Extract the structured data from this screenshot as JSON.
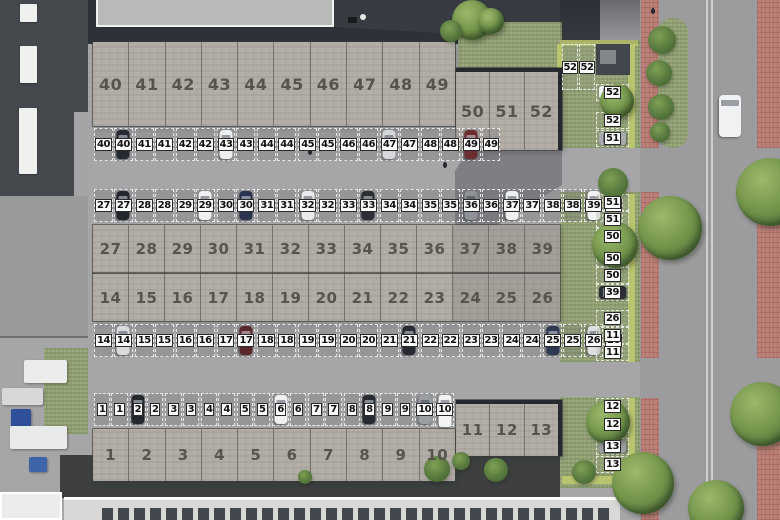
{
  "palette": {
    "asphalt": "#a6a6a8",
    "dark_roof": "#383c42",
    "brick_building": "#b2aea6",
    "grass": "#93a274",
    "hedge": "#b9c46f",
    "red_bike_path": "#bb8078",
    "road": "#9c9c9e",
    "road_line": "#cfcfd1",
    "white_roof": "#d8d8d6",
    "solar_panel": "#42464d",
    "unit_text": "#57544e",
    "chip_bg": "#fafafa",
    "chip_text": "#111111"
  },
  "buildings": [
    {
      "name": "building-units-40-49",
      "x": 93,
      "y": 42,
      "w": 362,
      "h": 84,
      "label_size": 16,
      "units": [
        "40",
        "41",
        "42",
        "43",
        "44",
        "45",
        "46",
        "47",
        "48",
        "49"
      ]
    },
    {
      "name": "building-units-50-52",
      "x": 456,
      "y": 68,
      "w": 106,
      "h": 82,
      "label_size": 16,
      "roof_edge": true,
      "units": [
        "50",
        "51",
        "52"
      ]
    },
    {
      "name": "building-units-27-39",
      "x": 93,
      "y": 225,
      "w": 467,
      "h": 48,
      "label_size": 15,
      "dark_from": 10,
      "units": [
        "27",
        "28",
        "29",
        "30",
        "31",
        "32",
        "33",
        "34",
        "35",
        "36",
        "37",
        "38",
        "39"
      ]
    },
    {
      "name": "building-units-14-26",
      "x": 93,
      "y": 273,
      "w": 467,
      "h": 48,
      "label_size": 15,
      "dark_from": 10,
      "divider": true,
      "units": [
        "14",
        "15",
        "16",
        "17",
        "18",
        "19",
        "20",
        "21",
        "22",
        "23",
        "24",
        "25",
        "26"
      ]
    },
    {
      "name": "building-units-1-10",
      "x": 93,
      "y": 429,
      "w": 362,
      "h": 52,
      "label_size": 15,
      "units": [
        "1",
        "2",
        "3",
        "4",
        "5",
        "6",
        "7",
        "8",
        "9",
        "10"
      ]
    },
    {
      "name": "building-units-11-13",
      "x": 456,
      "y": 400,
      "w": 106,
      "h": 56,
      "label_size": 15,
      "roof_edge": true,
      "units": [
        "11",
        "12",
        "13"
      ]
    }
  ],
  "parking_rows": [
    {
      "name": "parking-row-40-49",
      "x": 93,
      "y": 126,
      "w": 362,
      "h": 37,
      "labels": [
        "40",
        "41",
        "42",
        "43",
        "44",
        "45",
        "46",
        "47",
        "48",
        "49"
      ],
      "cars": [
        {
          "g": 0,
          "s": 1,
          "c": "#262a33"
        },
        {
          "g": 3,
          "s": 0,
          "c": "#edeff1"
        },
        {
          "g": 7,
          "s": 0,
          "c": "#d5d7da"
        },
        {
          "g": 9,
          "s": 0,
          "c": "#6d2b32"
        }
      ]
    },
    {
      "name": "parking-row-27-39",
      "x": 93,
      "y": 187,
      "w": 467,
      "h": 37,
      "labels": [
        "27",
        "28",
        "29",
        "30",
        "31",
        "32",
        "33",
        "34",
        "35",
        "36",
        "37",
        "38",
        "39"
      ],
      "cars": [
        {
          "g": 0,
          "s": 1,
          "c": "#23262d"
        },
        {
          "g": 2,
          "s": 1,
          "c": "#eef0f2"
        },
        {
          "g": 3,
          "s": 1,
          "c": "#2b3550"
        },
        {
          "g": 5,
          "s": 0,
          "c": "#e9ebed"
        },
        {
          "g": 6,
          "s": 1,
          "c": "#2b2e35"
        },
        {
          "g": 9,
          "s": 0,
          "c": "#8f9296"
        },
        {
          "g": 10,
          "s": 0,
          "c": "#edeff1"
        },
        {
          "g": 12,
          "s": 0,
          "c": "#f0f1f3"
        }
      ]
    },
    {
      "name": "parking-row-14-26",
      "x": 93,
      "y": 322,
      "w": 467,
      "h": 37,
      "labels": [
        "14",
        "15",
        "16",
        "17",
        "18",
        "19",
        "20",
        "21",
        "22",
        "23",
        "24",
        "25",
        "26"
      ],
      "cars": [
        {
          "g": 0,
          "s": 1,
          "c": "#d9dbdd"
        },
        {
          "g": 3,
          "s": 1,
          "c": "#5a272d"
        },
        {
          "g": 7,
          "s": 1,
          "c": "#272a30"
        },
        {
          "g": 11,
          "s": 0,
          "c": "#2d3853"
        },
        {
          "g": 12,
          "s": 0,
          "c": "#dddfe1"
        }
      ]
    },
    {
      "name": "parking-row-1-10",
      "x": 93,
      "y": 391,
      "w": 362,
      "h": 37,
      "labels": [
        "1",
        "2",
        "3",
        "4",
        "5",
        "6",
        "7",
        "8",
        "9",
        "10"
      ],
      "cars": [
        {
          "g": 1,
          "s": 0,
          "c": "#24272d"
        },
        {
          "g": 5,
          "s": 0,
          "c": "#eef0f2"
        },
        {
          "g": 7,
          "s": 1,
          "c": "#272a30"
        },
        {
          "g": 9,
          "s": 0,
          "c": "#9b9ea2"
        },
        {
          "g": 9,
          "s": 1,
          "c": "#f2f3f4",
          "van": true
        }
      ]
    }
  ],
  "side_strip": {
    "pair_spots": {
      "labels": [
        "52",
        "52"
      ]
    },
    "spots": [
      {
        "label": "52",
        "y": 84,
        "car": "#eef0f2"
      },
      {
        "label": "52",
        "y": 112
      },
      {
        "label": "51",
        "y": 130,
        "car": "#a8aaae"
      },
      {
        "label": "51",
        "y": 194
      },
      {
        "label": "51",
        "y": 211
      },
      {
        "label": "50",
        "y": 228,
        "car": "#75787e"
      },
      {
        "label": "50",
        "y": 250
      },
      {
        "label": "50",
        "y": 267
      },
      {
        "label": "39",
        "y": 284,
        "car": "#2b2e35"
      },
      {
        "label": "26",
        "y": 310
      },
      {
        "label": "11",
        "y": 327
      },
      {
        "label": "11",
        "y": 344
      },
      {
        "label": "12",
        "y": 398
      },
      {
        "label": "12",
        "y": 416
      },
      {
        "label": "13",
        "y": 438,
        "car": "#9b9ea2"
      },
      {
        "label": "13",
        "y": 456
      }
    ]
  },
  "road_car": {
    "x": 719,
    "y": 95,
    "w": 22,
    "h": 42,
    "c": "#f0f1f3"
  },
  "trees": [
    {
      "x": 452,
      "y": 0,
      "d": 40,
      "type": "tree"
    },
    {
      "x": 478,
      "y": 8,
      "d": 26,
      "type": "tree"
    },
    {
      "x": 440,
      "y": 20,
      "d": 22,
      "type": "bush"
    },
    {
      "x": 600,
      "y": 84,
      "d": 34,
      "type": "tree"
    },
    {
      "x": 598,
      "y": 168,
      "d": 30,
      "type": "bush"
    },
    {
      "x": 592,
      "y": 222,
      "d": 46,
      "type": "tree"
    },
    {
      "x": 586,
      "y": 400,
      "d": 44,
      "type": "tree"
    },
    {
      "x": 648,
      "y": 26,
      "d": 28,
      "type": "bush"
    },
    {
      "x": 646,
      "y": 60,
      "d": 26,
      "type": "bush"
    },
    {
      "x": 648,
      "y": 94,
      "d": 26,
      "type": "bush"
    },
    {
      "x": 650,
      "y": 122,
      "d": 20,
      "type": "bush"
    },
    {
      "x": 638,
      "y": 196,
      "d": 64,
      "type": "tree"
    },
    {
      "x": 736,
      "y": 158,
      "d": 68,
      "type": "tree"
    },
    {
      "x": 730,
      "y": 382,
      "d": 64,
      "type": "tree"
    },
    {
      "x": 612,
      "y": 452,
      "d": 62,
      "type": "tree"
    },
    {
      "x": 688,
      "y": 480,
      "d": 56,
      "type": "tree"
    },
    {
      "x": 424,
      "y": 456,
      "d": 26,
      "type": "bush"
    },
    {
      "x": 452,
      "y": 452,
      "d": 18,
      "type": "bush"
    },
    {
      "x": 484,
      "y": 458,
      "d": 24,
      "type": "bush"
    },
    {
      "x": 572,
      "y": 460,
      "d": 24,
      "type": "bush"
    },
    {
      "x": 298,
      "y": 470,
      "d": 14,
      "type": "bush"
    }
  ],
  "trailers": [
    {
      "x": 20,
      "y": 4,
      "w": 17,
      "h": 18
    },
    {
      "x": 20,
      "y": 46,
      "w": 17,
      "h": 37
    },
    {
      "x": 19,
      "y": 108,
      "w": 18,
      "h": 66
    }
  ],
  "trucks": [
    {
      "x": 24,
      "y": 360,
      "w": 43,
      "h": 23,
      "c": "#ebecec"
    },
    {
      "x": 2,
      "y": 388,
      "w": 41,
      "h": 17,
      "c": "#d6d8d9"
    },
    {
      "x": 11,
      "y": 409,
      "w": 20,
      "h": 18,
      "c": "#2f4f9a"
    },
    {
      "x": 10,
      "y": 426,
      "w": 57,
      "h": 23,
      "c": "#e9eaea"
    },
    {
      "x": 29,
      "y": 457,
      "w": 18,
      "h": 15,
      "c": "#3e64a9"
    }
  ],
  "pedestrians": [
    {
      "x": 308,
      "y": 149
    },
    {
      "x": 651,
      "y": 8
    },
    {
      "x": 443,
      "y": 162
    }
  ]
}
